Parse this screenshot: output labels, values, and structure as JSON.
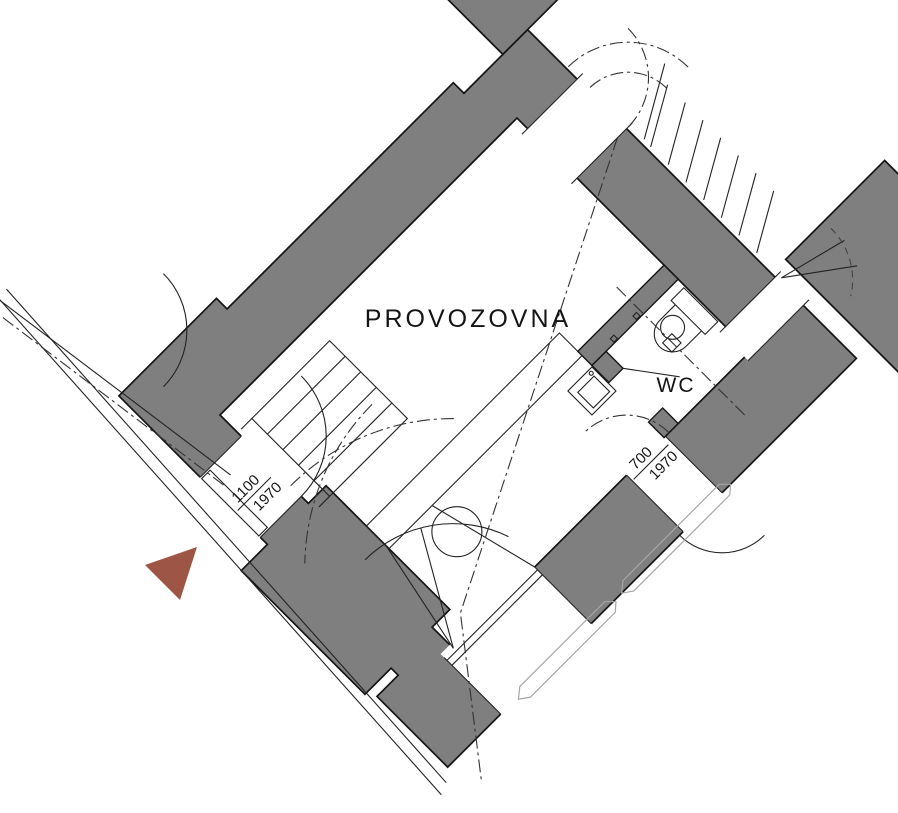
{
  "labels": {
    "main_room": "PROVOZOVNA",
    "wc": "WC"
  },
  "dimensions": {
    "left_door": {
      "width": "1100",
      "height": "1970"
    },
    "rear_door": {
      "width": "700",
      "height": "1970"
    }
  },
  "colors": {
    "wall": "#7f7f7f",
    "entrance_marker": "#9D5645",
    "line": "#141414",
    "background": "#ffffff"
  }
}
